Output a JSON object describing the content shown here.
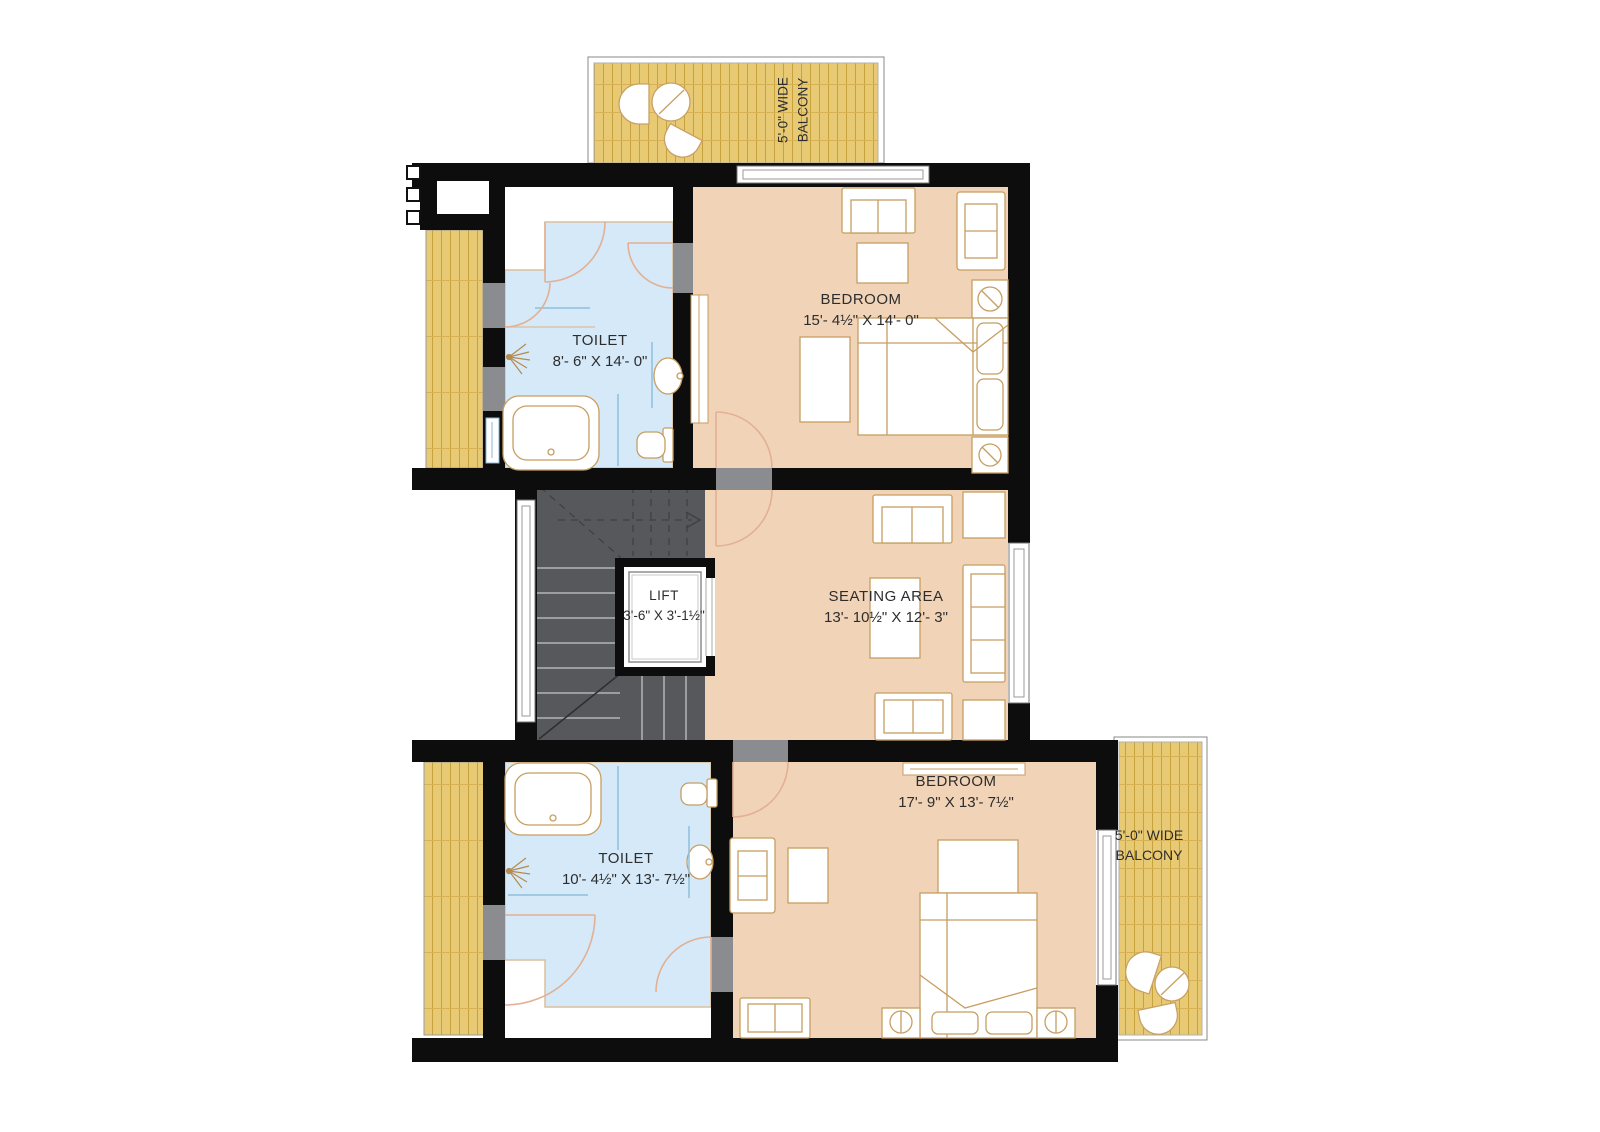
{
  "rooms": {
    "toilet_top": {
      "name": "TOILET",
      "dims": "8'- 6\" X 14'- 0\""
    },
    "bedroom_top": {
      "name": "BEDROOM",
      "dims": "15'- 4½\" X 14'- 0\""
    },
    "lift": {
      "name": "LIFT",
      "dims": "3'-6\" X 3'-1½\""
    },
    "seating_area": {
      "name": "SEATING AREA",
      "dims": "13'- 10½\" X 12'- 3\""
    },
    "toilet_bottom": {
      "name": "TOILET",
      "dims": "10'- 4½\" X 13'- 7½\""
    },
    "bedroom_bottom": {
      "name": "BEDROOM",
      "dims": "17'- 9\" X 13'- 7½\""
    }
  },
  "balconies": {
    "top": {
      "line1": "5'-0\" WIDE",
      "line2": "BALCONY"
    },
    "bottom": {
      "line1": "5'-0\" WIDE",
      "line2": "BALCONY"
    }
  },
  "colors": {
    "wall": "#0d0d0d",
    "bedroom": "#f1d3b7",
    "toilet": "#d5e9f8",
    "balcony": "#e9ca74",
    "stairs": "#57585b",
    "furniture_line": "#c79e61",
    "door_swing": "#e3b093",
    "label_text": "#2d2d2d"
  }
}
